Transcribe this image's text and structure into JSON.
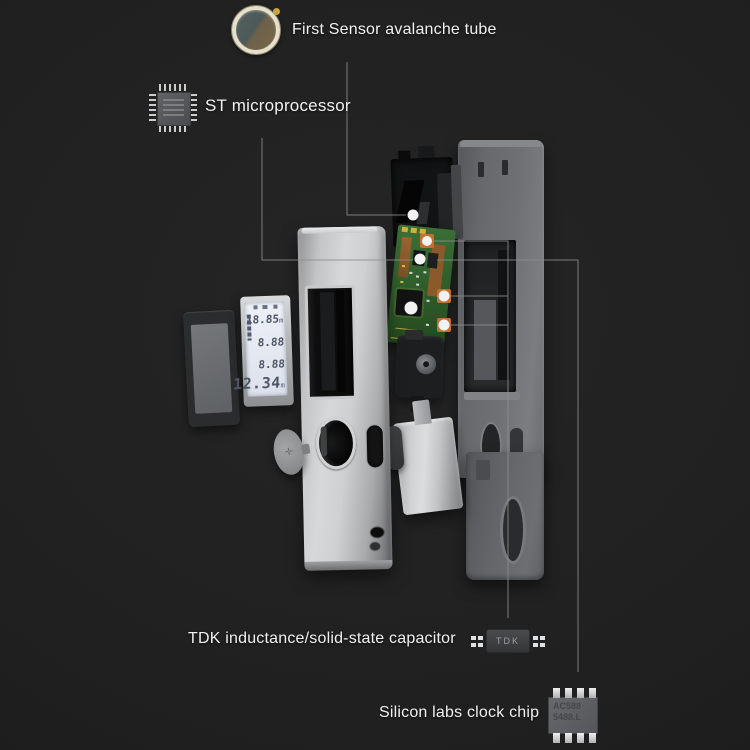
{
  "callouts": {
    "sensor": {
      "label": "First Sensor avalanche tube"
    },
    "mcu": {
      "label": "ST microprocessor"
    },
    "tdk": {
      "label": "TDK inductance/solid-state capacitor",
      "chip_text": "TDK"
    },
    "clock": {
      "label": "Silicon labs clock chip",
      "chip_line1": "AC588",
      "chip_line2": "5488.L"
    }
  },
  "lcd": {
    "rows": [
      {
        "value": "18.85",
        "unit": "m"
      },
      {
        "value": "8.88",
        "unit": ""
      },
      {
        "value": "8.88",
        "unit": ""
      },
      {
        "value": "12.34",
        "unit": "m"
      }
    ]
  },
  "colors": {
    "background": "#202020",
    "label_text": "#f1f1f1",
    "callout_line": "#8c8c8c",
    "callout_dot": "#f3f3f3",
    "pcb_green": "#336a2f",
    "body_metal": "#c6c7c9",
    "housing_gray": "#6e7073",
    "component_orange": "#c76f30"
  }
}
